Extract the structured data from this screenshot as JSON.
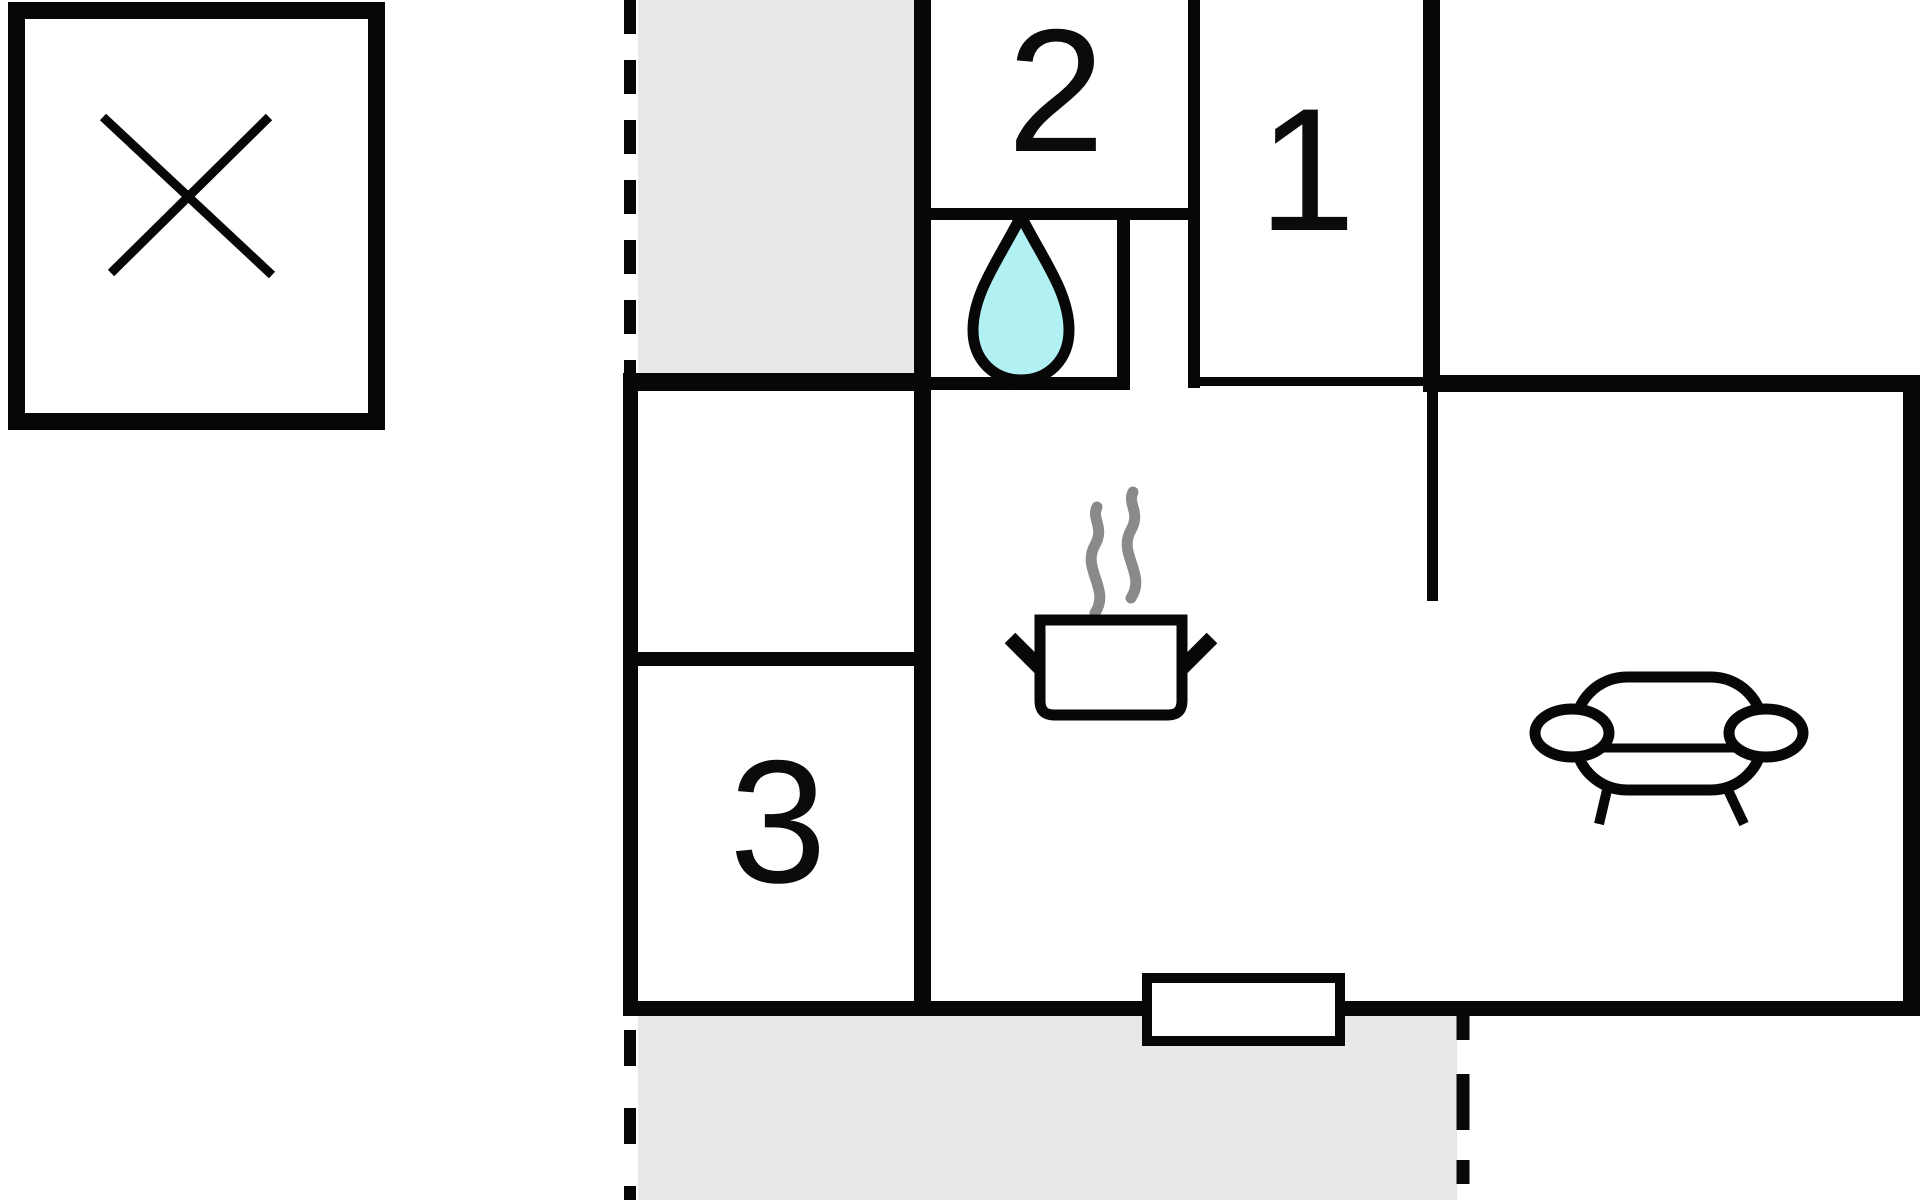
{
  "plan": {
    "type": "floor-plan",
    "rooms": [
      {
        "id": "room-1",
        "label": "1"
      },
      {
        "id": "room-2",
        "label": "2"
      },
      {
        "id": "room-3",
        "label": "3"
      }
    ],
    "icons": {
      "annex": "x-marker-icon",
      "bathroom": "water-drop-icon",
      "kitchen": "steaming-pot-icon",
      "living_room": "sofa-icon"
    },
    "colors": {
      "wall": "#070707",
      "label": "#0b0b0b",
      "terrace": "#e8e8ea",
      "water_fill": "#b2f1f3",
      "steam": "#8a8a8a",
      "background": "#ffffff"
    }
  }
}
